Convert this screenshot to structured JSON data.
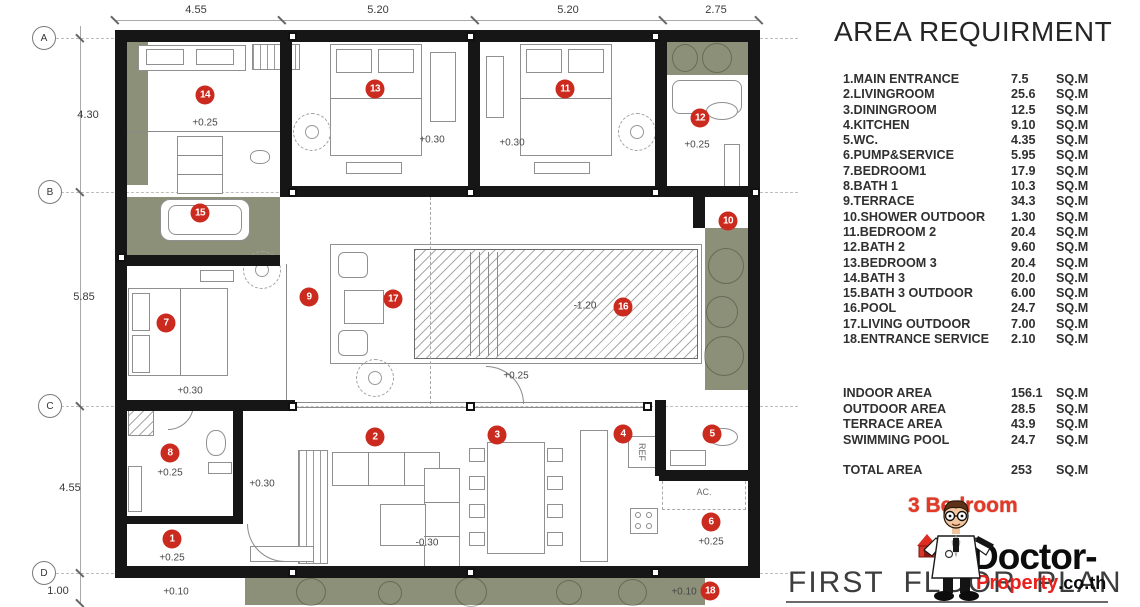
{
  "plan": {
    "title": "FIRST FLOOR PLAN",
    "grid_bubbles": [
      {
        "label": "A",
        "x": 44,
        "y": 38
      },
      {
        "label": "B",
        "x": 50,
        "y": 192
      },
      {
        "label": "C",
        "x": 50,
        "y": 406
      },
      {
        "label": "D",
        "x": 44,
        "y": 573
      }
    ],
    "dims_left": [
      {
        "text": "4.30",
        "x": 88,
        "y": 115
      },
      {
        "text": "5.85",
        "x": 84,
        "y": 297
      },
      {
        "text": "4.55",
        "x": 70,
        "y": 488
      },
      {
        "text": "1.00",
        "x": 58,
        "y": 591
      }
    ],
    "dims_top": [
      {
        "text": "4.55",
        "x": 196,
        "y": 10
      },
      {
        "text": "5.20",
        "x": 378,
        "y": 10
      },
      {
        "text": "5.20",
        "x": 568,
        "y": 10
      },
      {
        "text": "2.75",
        "x": 716,
        "y": 10
      }
    ],
    "dim_ticks_top": [
      115,
      282,
      475,
      663,
      759
    ],
    "dim_ticks_left": [
      38,
      192,
      406,
      573,
      603
    ],
    "markers": [
      {
        "n": "1",
        "x": 172,
        "y": 539
      },
      {
        "n": "2",
        "x": 375,
        "y": 437
      },
      {
        "n": "3",
        "x": 497,
        "y": 435
      },
      {
        "n": "4",
        "x": 623,
        "y": 434
      },
      {
        "n": "5",
        "x": 712,
        "y": 434
      },
      {
        "n": "6",
        "x": 711,
        "y": 522
      },
      {
        "n": "7",
        "x": 166,
        "y": 323
      },
      {
        "n": "8",
        "x": 170,
        "y": 453
      },
      {
        "n": "9",
        "x": 309,
        "y": 297
      },
      {
        "n": "10",
        "x": 728,
        "y": 221
      },
      {
        "n": "11",
        "x": 565,
        "y": 89
      },
      {
        "n": "12",
        "x": 700,
        "y": 118
      },
      {
        "n": "13",
        "x": 375,
        "y": 89
      },
      {
        "n": "14",
        "x": 205,
        "y": 95
      },
      {
        "n": "15",
        "x": 200,
        "y": 213
      },
      {
        "n": "16",
        "x": 623,
        "y": 307
      },
      {
        "n": "17",
        "x": 393,
        "y": 299
      },
      {
        "n": "18",
        "x": 710,
        "y": 591
      }
    ],
    "levels": [
      {
        "text": "+0.25",
        "x": 205,
        "y": 123
      },
      {
        "text": "+0.30",
        "x": 432,
        "y": 140
      },
      {
        "text": "+0.30",
        "x": 512,
        "y": 143
      },
      {
        "text": "+0.25",
        "x": 697,
        "y": 145
      },
      {
        "text": "-1.20",
        "x": 585,
        "y": 306
      },
      {
        "text": "+0.25",
        "x": 516,
        "y": 376
      },
      {
        "text": "+0.30",
        "x": 190,
        "y": 391
      },
      {
        "text": "+0.25",
        "x": 170,
        "y": 473
      },
      {
        "text": "+0.30",
        "x": 262,
        "y": 484
      },
      {
        "text": "-0.30",
        "x": 427,
        "y": 543
      },
      {
        "text": "+0.25",
        "x": 172,
        "y": 558
      },
      {
        "text": "+0.25",
        "x": 711,
        "y": 542
      },
      {
        "text": "+0.10",
        "x": 176,
        "y": 592
      },
      {
        "text": "+0.10",
        "x": 684,
        "y": 592
      }
    ],
    "labels": [
      {
        "text": "REF",
        "x": 642,
        "y": 452,
        "rot": 90
      },
      {
        "text": "AC.",
        "x": 704,
        "y": 492,
        "rot": 0
      }
    ]
  },
  "area_table": {
    "title": "AREA REQUIRMENT",
    "unit": "SQ.M",
    "items": [
      {
        "name": "1.MAIN ENTRANCE",
        "value": "7.5"
      },
      {
        "name": "2.LIVINGROOM",
        "value": "25.6"
      },
      {
        "name": "3.DININGROOM",
        "value": "12.5"
      },
      {
        "name": "4.KITCHEN",
        "value": "9.10"
      },
      {
        "name": "5.WC.",
        "value": "4.35"
      },
      {
        "name": "6.PUMP&SERVICE",
        "value": "5.95"
      },
      {
        "name": "7.BEDROOM1",
        "value": "17.9"
      },
      {
        "name": "8.BATH 1",
        "value": "10.3"
      },
      {
        "name": "9.TERRACE",
        "value": "34.3"
      },
      {
        "name": "10.SHOWER OUTDOOR",
        "value": "1.30"
      },
      {
        "name": "11.BEDROOM 2",
        "value": "20.4"
      },
      {
        "name": "12.BATH 2",
        "value": "9.60"
      },
      {
        "name": "13.BEDROOM 3",
        "value": "20.4"
      },
      {
        "name": "14.BATH 3",
        "value": "20.0"
      },
      {
        "name": "15.BATH 3 OUTDOOR",
        "value": "6.00"
      },
      {
        "name": "16.POOL",
        "value": "24.7"
      },
      {
        "name": "17.LIVING OUTDOOR",
        "value": "7.00"
      },
      {
        "name": "18.ENTRANCE SERVICE",
        "value": "2.10"
      }
    ],
    "summary": [
      {
        "name": "INDOOR AREA",
        "value": "156.1"
      },
      {
        "name": "OUTDOOR AREA",
        "value": "28.5"
      },
      {
        "name": "TERRACE AREA",
        "value": "43.9"
      },
      {
        "name": "SWIMMING POOL",
        "value": "24.7"
      }
    ],
    "total": {
      "name": "TOTAL AREA",
      "value": "253",
      "unit": "SQ.M"
    }
  },
  "branding": {
    "badge": "3 Bedroom",
    "brand_main": "Doctor-",
    "brand_sub_red": "Property",
    "brand_sub_black": ".co.th"
  },
  "colors": {
    "marker_red": "#cb2a1e",
    "wall_black": "#161616",
    "planting_green": "#8d9078",
    "brand_red": "#e8211c"
  }
}
